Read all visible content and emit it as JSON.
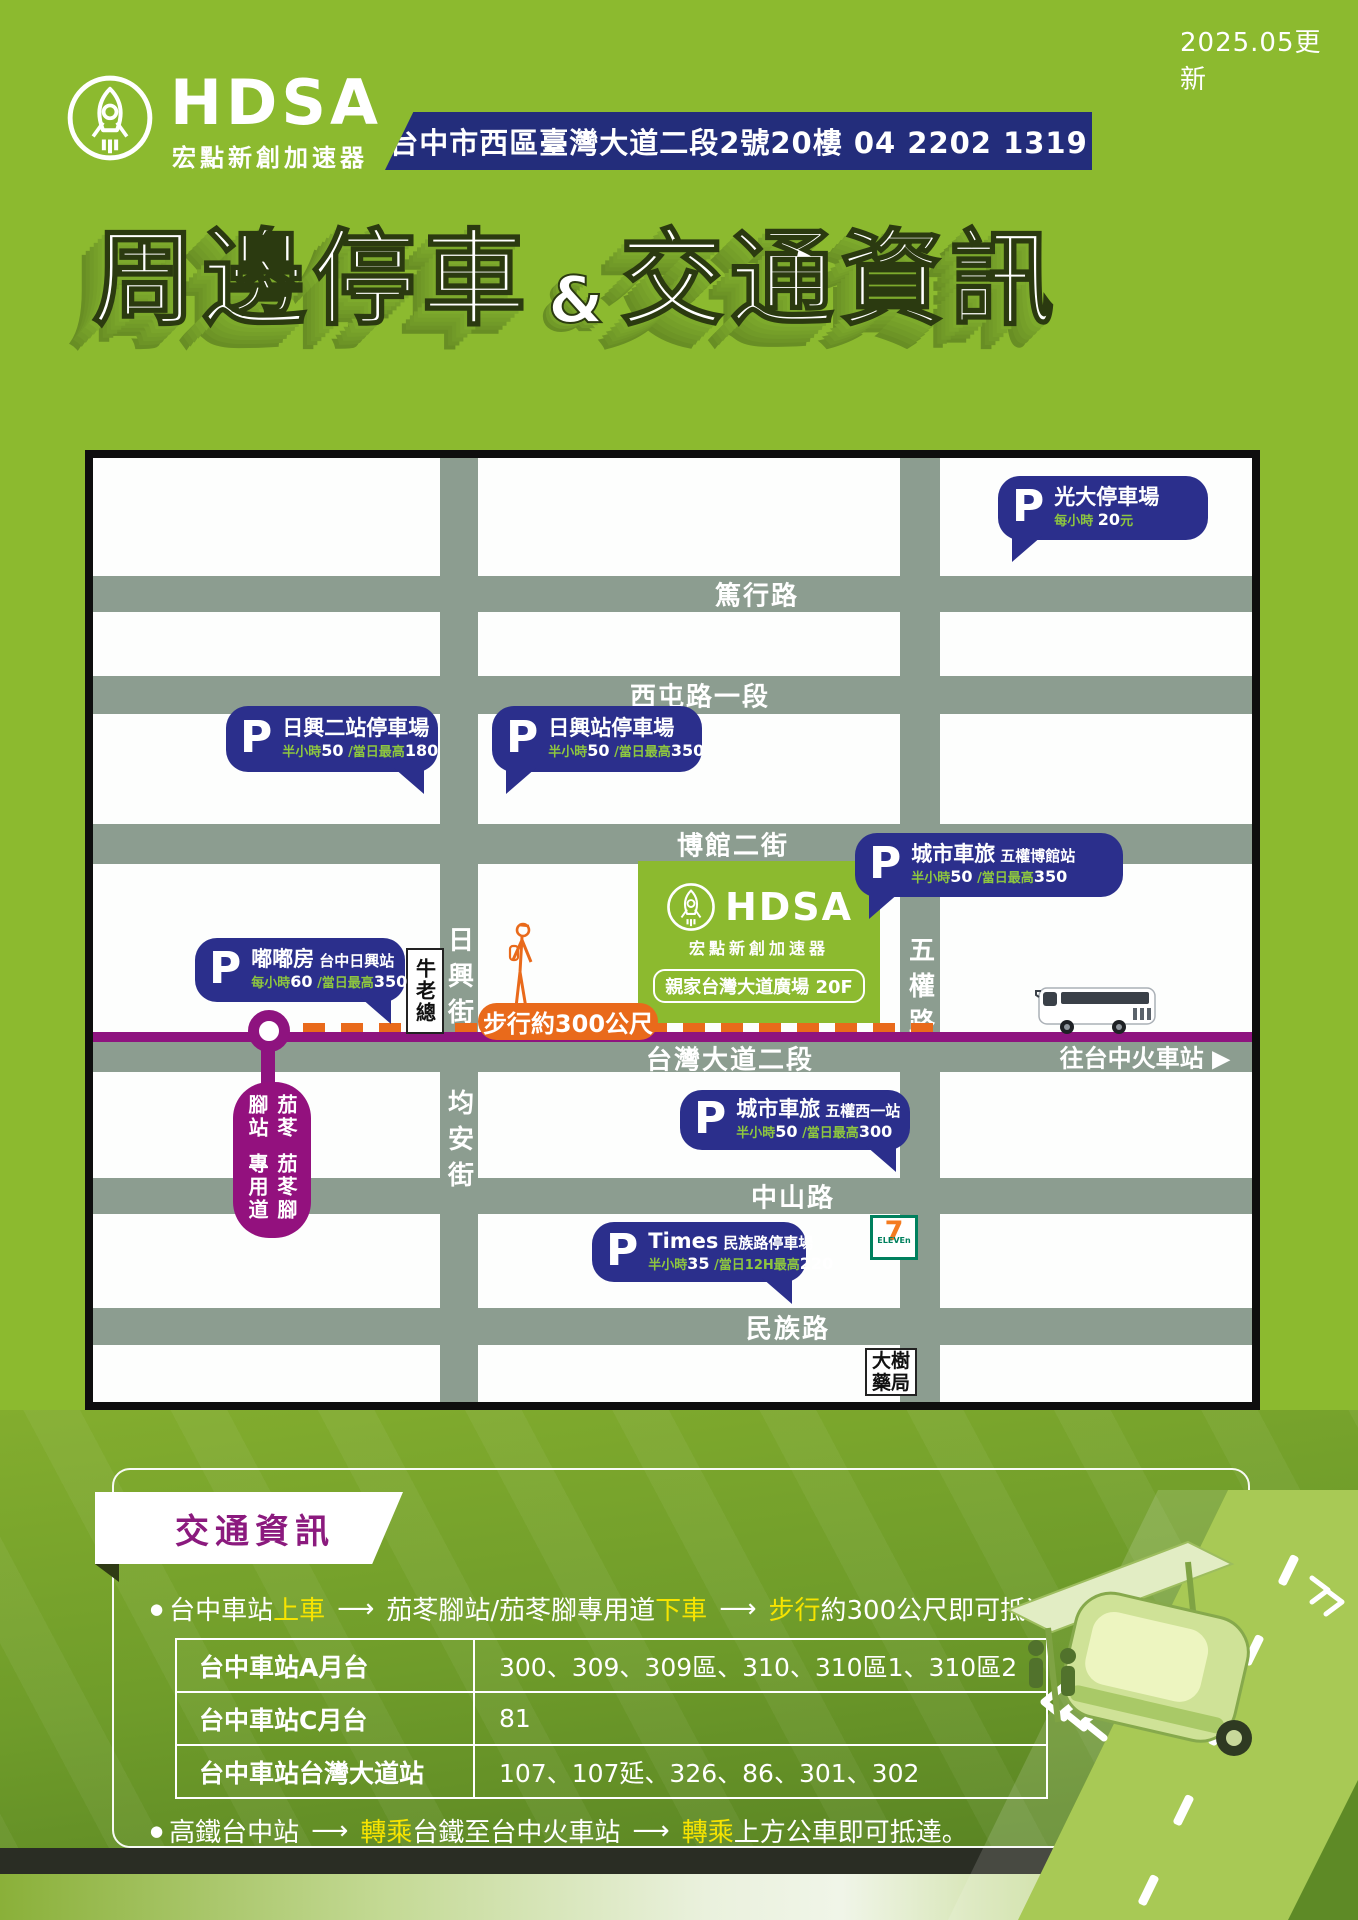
{
  "header": {
    "updated": "2025.05更新",
    "brand": "HDSA",
    "brand_sub": "宏點新創加速器",
    "address": "台中市西區臺灣大道二段2號20樓 04 2202 1319",
    "title_left": "周邊停車",
    "title_amp": "&",
    "title_right": "交通資訊"
  },
  "map": {
    "streets": {
      "duxing": "篤行路",
      "xitun": "西屯路一段",
      "boguan": "博館二街",
      "taiwan_blvd": "台灣大道二段",
      "zhongshan": "中山路",
      "minzu": "民族路",
      "rixing_st": "日興街",
      "junan_st": "均安街",
      "wuquan_rd": "五權路"
    },
    "direction_note": {
      "text": "往台中火車站",
      "arrow": "▶"
    },
    "walk_label": "步行約300公尺",
    "landmark_niulaozong": "牛老總",
    "landmark_dashu": {
      "line1": "大樹",
      "line2": "藥局"
    },
    "landmark_711": {
      "seven": "7",
      "eleven": "ELEVEn"
    },
    "building": {
      "brand": "HDSA",
      "brand_sub": "宏點新創加速器",
      "address_chip": "親家台灣大道廣場 20F"
    },
    "brt_stop": {
      "col_right": "茄苳腳站",
      "col_left": "茄苳腳專用道"
    },
    "note": "＊停車費依現場公告為主",
    "parkings": {
      "guangda": {
        "p": "P",
        "name": "光大停車場",
        "fee_a": "每小時",
        "fee_b": "20",
        "fee_c": "元"
      },
      "rixing2": {
        "p": "P",
        "name": "日興二站停車場",
        "fee_a": "半小時",
        "fee_b": "50",
        "fee_c": "/當日最高",
        "fee_d": "180"
      },
      "rixing": {
        "p": "P",
        "name": "日興站停車場",
        "fee_a": "半小時",
        "fee_b": "50",
        "fee_c": "/當日最高",
        "fee_d": "350"
      },
      "city_boguan": {
        "p": "P",
        "name": "城市車旅",
        "sub": "五權博館站",
        "fee_a": "半小時",
        "fee_b": "50",
        "fee_c": "/當日最高",
        "fee_d": "350"
      },
      "dudufang": {
        "p": "P",
        "name": "嘟嘟房",
        "sub": "台中日興站",
        "fee_a": "每小時",
        "fee_b": "60",
        "fee_c": "/當日最高",
        "fee_d": "350"
      },
      "city_wuquan": {
        "p": "P",
        "name": "城市車旅",
        "sub": "五權西一站",
        "fee_a": "半小時",
        "fee_b": "50",
        "fee_c": "/當日最高",
        "fee_d": "300"
      },
      "times": {
        "p": "P",
        "name": "Times",
        "sub": "民族路停車場",
        "fee_a": "半小時",
        "fee_b": "35",
        "fee_c": "/當日12H最高",
        "fee_d": "220"
      }
    }
  },
  "traffic": {
    "section_title": "交通資訊",
    "bullet1": {
      "pre": "台中車站",
      "hl1": "上車",
      "arrow": "⟶",
      "mid": "茄苳腳站/茄苳腳專用道",
      "hl2": "下車",
      "arrow2": "⟶",
      "hl3": "步行",
      "post": "約300公尺即可抵達。"
    },
    "table": {
      "rows": [
        {
          "label": "台中車站A月台",
          "value": "300、309、309區、310、310區1、310區2"
        },
        {
          "label": "台中車站C月台",
          "value": "81"
        },
        {
          "label": "台中車站台灣大道站",
          "value": "107、107延、326、86、301、302"
        }
      ]
    },
    "bullet2": {
      "pre": "高鐵台中站",
      "arrow": "⟶",
      "hl1": "轉乘",
      "mid": "台鐵至台中火車站",
      "arrow2": "⟶",
      "hl2": "轉乘",
      "post": "上方公車即可抵達。"
    }
  },
  "colors": {
    "accent_green": "#8CBA2F",
    "navy": "#2B2F8C",
    "purple": "#93117E",
    "orange": "#E96A1B",
    "fee_green": "#8DC63F",
    "highlight_yellow": "#F7E400"
  }
}
